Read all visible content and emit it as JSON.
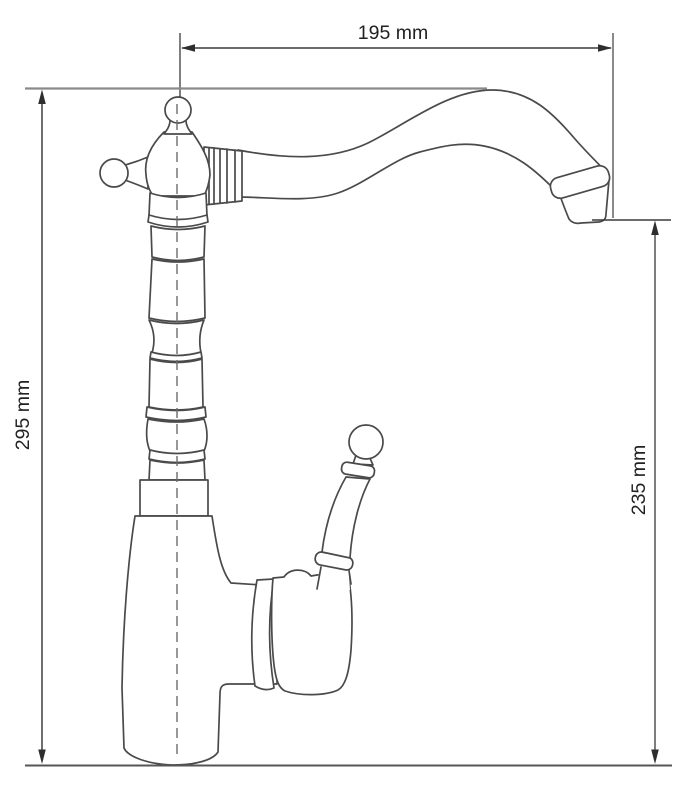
{
  "drawing": {
    "type": "technical-dimension-diagram",
    "subject": "retro single-lever kitchen faucet, side elevation",
    "colors": {
      "outline": "#4a4a4a",
      "dimension_line": "#3a3a3a",
      "extension_line": "#8a8a8a",
      "centerline": "#6b6b6b",
      "text": "#222222",
      "background": "#ffffff"
    },
    "dimensions": [
      {
        "id": "spout-reach",
        "label": "195 mm",
        "orientation": "horizontal",
        "position": "top"
      },
      {
        "id": "overall-height",
        "label": "295 mm",
        "orientation": "vertical",
        "position": "left"
      },
      {
        "id": "outlet-height",
        "label": "235 mm",
        "orientation": "vertical",
        "position": "right"
      }
    ]
  }
}
